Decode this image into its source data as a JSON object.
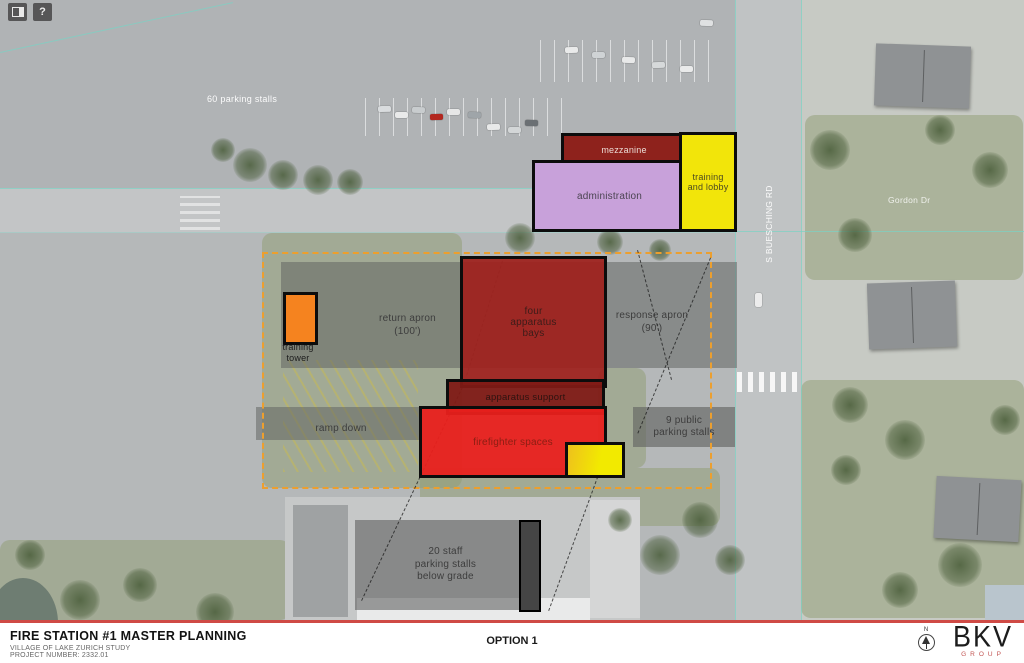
{
  "toolbar": {
    "overview_button": "",
    "help_button": "?"
  },
  "map_labels": {
    "parking_60": "60 parking stalls",
    "street_buesching": "S BUESCHING RD",
    "street_gordon": "Gordon Dr"
  },
  "plan": {
    "mezzanine": "mezzanine",
    "administration": "administration",
    "training_lobby": "training\nand lobby",
    "apparatus_bays": "four\napparatus\nbays",
    "apparatus_support": "apparatus support",
    "firefighter_spaces": "firefighter spaces",
    "return_apron": "return apron\n(100')",
    "response_apron": "response apron\n(90')",
    "ramp_down": "ramp down",
    "training_tower": "training\ntower",
    "public_parking": "9 public\nparking stalls",
    "staff_parking": "20 staff\nparking stalls\nbelow grade"
  },
  "footer": {
    "title": "FIRE STATION #1 MASTER PLANNING",
    "subtitle1": "VILLAGE OF LAKE ZURICH STUDY",
    "subtitle2": "PROJECT NUMBER: 2332.01",
    "option": "OPTION 1",
    "logo_name": "BKV",
    "logo_group": "GROUP",
    "north_label": "N"
  },
  "colors": {
    "mezzanine": "#8e221c",
    "administration": "#c8a1da",
    "training_lobby": "#f2e50a",
    "apparatus_bays": "#9e1f1b",
    "apparatus_support": "#801a15",
    "firefighter_spaces": "#e9201c",
    "training_tower": "#f5831f",
    "site_boundary": "#ec9f2e",
    "footer_rule": "#cf4a45",
    "logo_group_red": "#c25452"
  }
}
